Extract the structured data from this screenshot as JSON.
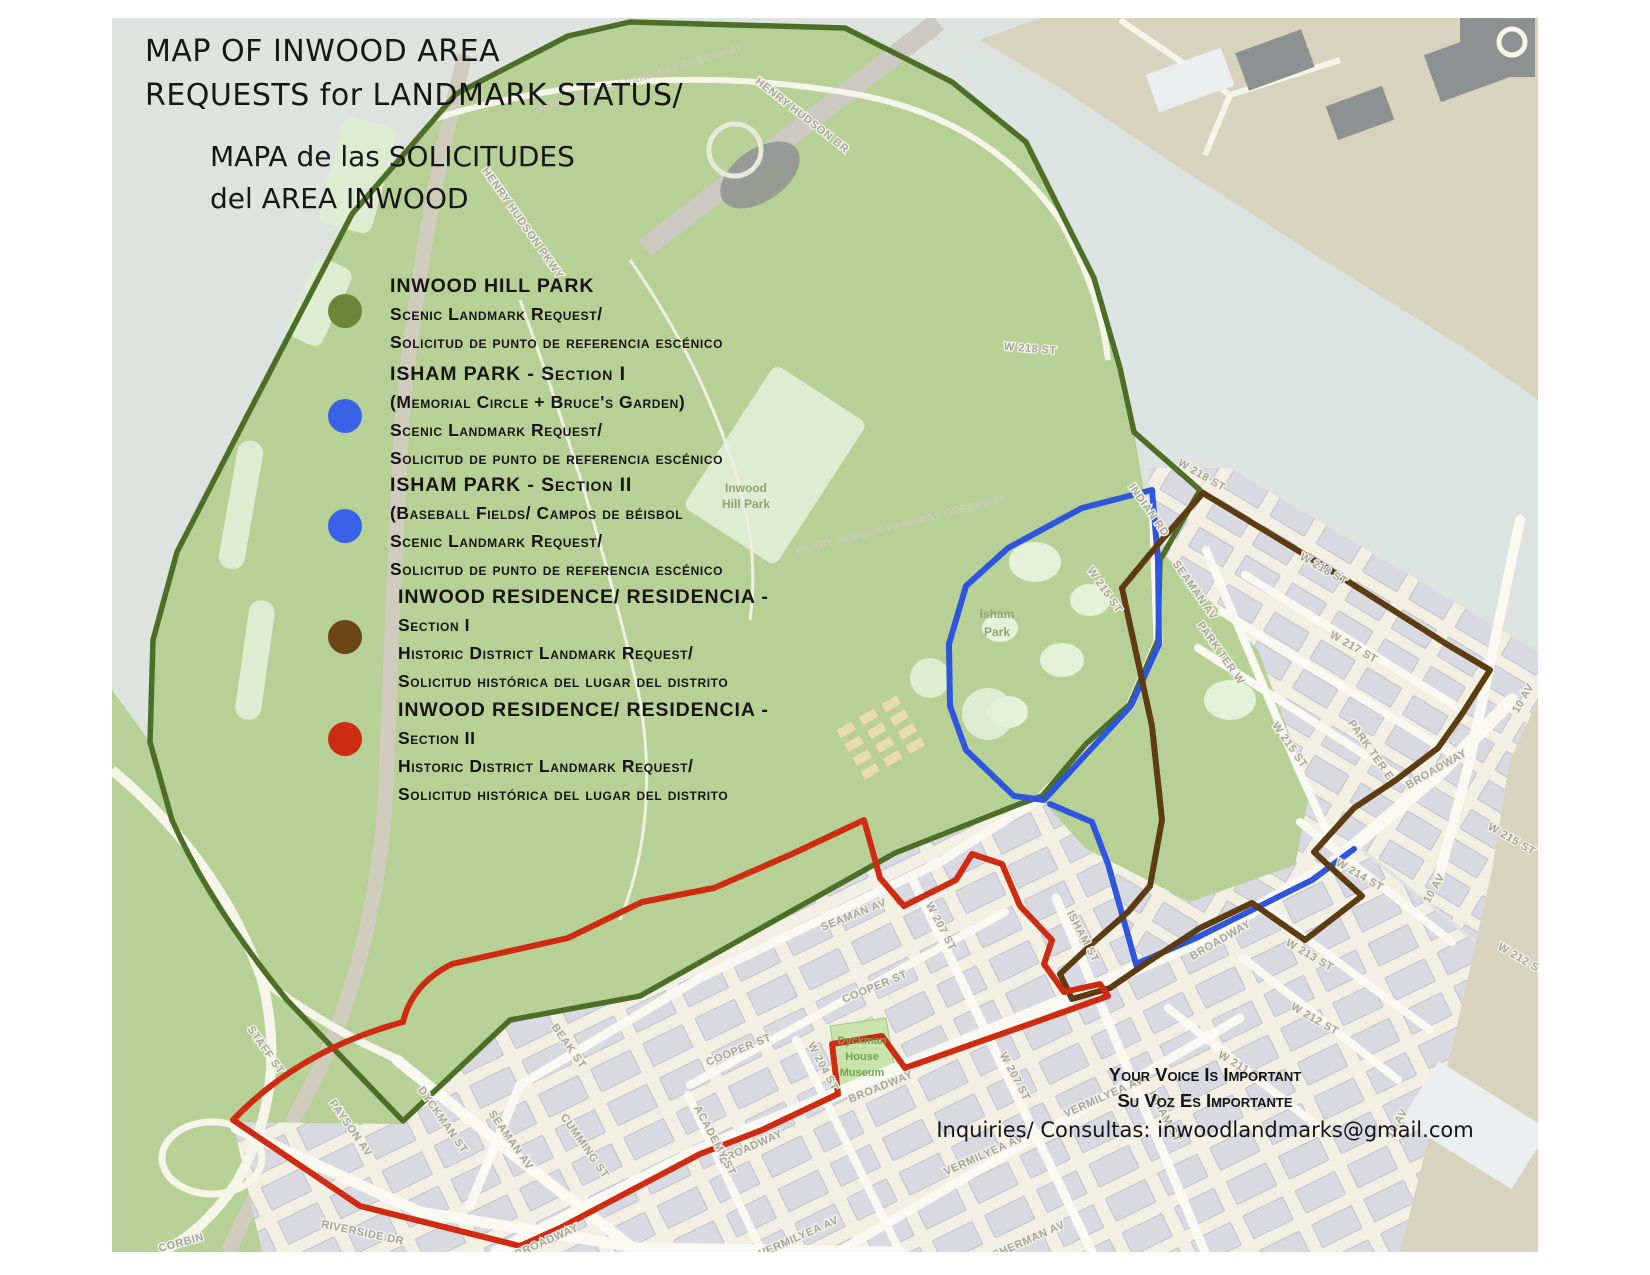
{
  "title": {
    "line1": "MAP OF INWOOD AREA",
    "line2": "REQUESTS for LANDMARK STATUS/",
    "line3": "MAPA de las SOLICITUDES",
    "line4": "del AREA INWOOD"
  },
  "legend": {
    "items": [
      {
        "color": "#6b8639",
        "lines": [
          "INWOOD HILL PARK",
          "Scenic Landmark Request/",
          "Solicitud de punto de referencia escénico"
        ]
      },
      {
        "color": "#3a62e8",
        "lines": [
          "ISHAM PARK - Section I",
          "(Memorial Circle + Bruce's Garden)",
          "Scenic Landmark Request/",
          "Solicitud de punto de referencia escénico"
        ]
      },
      {
        "color": "#3a62e8",
        "lines": [
          "ISHAM PARK - Section II",
          "(Baseball Fields/ Campos de béisbol",
          "Scenic Landmark Request/",
          "Solicitud de punto de referencia escénico"
        ]
      },
      {
        "color": "#6b4616",
        "lines": [
          "INWOOD RESIDENCE/ RESIDENCIA -",
          "Section I",
          "Historic District Landmark Request/",
          "Solicitud histórica del lugar del distrito"
        ]
      },
      {
        "color": "#cc2c10",
        "lines": [
          "INWOOD RESIDENCE/ RESIDENCIA -",
          "Section II",
          "Historic District Landmark Request/",
          "Solicitud histórica del lugar del distrito"
        ]
      }
    ]
  },
  "footer": {
    "line1": "Your Voice Is Important",
    "line2": "Su Voz Es Importante",
    "line3": "Inquiries/ Consultas: inwoodlandmarks@gmail.com"
  },
  "map": {
    "colors": {
      "water": "#dfe3df",
      "river": "#dce4e1",
      "park": "#b7d095",
      "field": "#dcedd2",
      "city": "#f1f0e3",
      "street": "#fbfaf2",
      "building": "#d9d9e2",
      "tan": "#d7d3bd",
      "dark_building": "#8e9191"
    },
    "boundaries": {
      "scenic_inwood_hill": {
        "color": "#4c6e27"
      },
      "scenic_isham": {
        "color": "#2e55dd"
      },
      "historic_section1": {
        "color": "#5e3c12"
      },
      "historic_section2": {
        "color": "#cf2b10"
      }
    },
    "street_labels": [
      "HENRY HUDSON PARKWAY GREENWAY",
      "HENRY HUDSON BR",
      "HENRY HUDSON PKWY",
      "W 218 ST",
      "HENRY HUDSON PARKWAY GREENWAY",
      "INDIAN RD",
      "W 218 ST",
      "W 215 ST",
      "SEAMAN AV",
      "W 218 ST",
      "W 217 ST",
      "PARK TER W",
      "W 215 ST",
      "PARK TER E",
      "10 AV",
      "BROADWAY",
      "W 215 ST",
      "W 214 ST",
      "10 AV",
      "W 213 ST",
      "BROADWAY",
      "W 212 ST",
      "W 211 ST",
      "10 AV",
      "STAFF ST",
      "PAYSON AV",
      "DYCKMAN ST",
      "SEAMAN AV",
      "BEAK ST",
      "CUMMING ST",
      "RIVERSIDE DR",
      "CORBIN",
      "BROADWAY",
      "SEAMAN AV",
      "W 207 ST",
      "COOPER ST",
      "COOPER ST",
      "W 204 ST",
      "BROADWAY",
      "BROADWAY",
      "VERMILYEA AV",
      "VERMILYEA AV",
      "W 207 ST",
      "ISHAM ST",
      "ISHAM ST",
      "ACADEMY ST",
      "VERMILYEA AV",
      "SHERMAN AV",
      "W 212 ST"
    ],
    "park_labels": [
      "Inwood",
      "Hill Park",
      "Isham",
      "Park",
      "Dyckman",
      "House",
      "Museum"
    ]
  }
}
